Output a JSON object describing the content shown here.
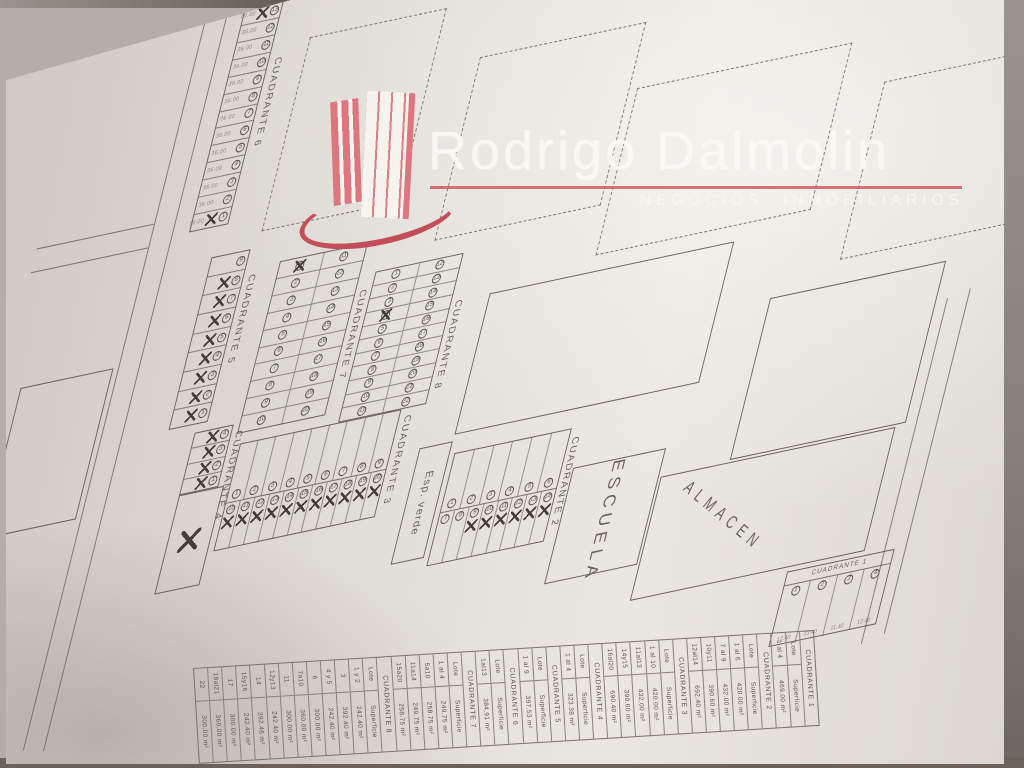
{
  "logo": {
    "brand": "Rodrigo Dalmolin",
    "tagline": "NEGOCIOS INMOBILIARIOS",
    "brand_color": "#f7f4ef",
    "accent_color": "#cf5a62",
    "icon": "building-icon"
  },
  "plan": {
    "areas": {
      "school": "ESCUELA",
      "warehouse": "ALMACEN",
      "green": "Esp. verde"
    },
    "c6": {
      "label": "CUADRANTE 6",
      "dim": "36.00",
      "lots": [
        {
          "n": "13",
          "x": true
        },
        {
          "n": "12"
        },
        {
          "n": "11"
        },
        {
          "n": "10"
        },
        {
          "n": "9"
        },
        {
          "n": "8"
        },
        {
          "n": "7"
        },
        {
          "n": "6"
        },
        {
          "n": "5"
        },
        {
          "n": "4"
        },
        {
          "n": "3"
        },
        {
          "n": "2"
        },
        {
          "n": "1",
          "x": true
        }
      ]
    },
    "c5": {
      "label": "CUADRANTE 5",
      "lots": [
        {
          "n": "9"
        },
        {
          "n": "8",
          "x": true
        },
        {
          "n": "7",
          "x": true
        },
        {
          "n": "6",
          "x": true
        },
        {
          "n": "5",
          "x": true
        },
        {
          "n": "4",
          "x": true
        },
        {
          "n": "3",
          "x": true
        },
        {
          "n": "2",
          "x": true
        },
        {
          "n": "1",
          "x": true
        }
      ]
    },
    "c4": {
      "label": "CUADRANTE 4",
      "lots": [
        {
          "n": "4",
          "x": true
        },
        {
          "n": "3",
          "x": true
        },
        {
          "n": "2",
          "x": true
        },
        {
          "n": "1",
          "x": true
        }
      ],
      "big_lot": {
        "x": true
      }
    },
    "c7": {
      "label": "CUADRANTE 7",
      "rows": [
        [
          {
            "n": "1",
            "x": true
          },
          {
            "n": "11"
          }
        ],
        [
          {
            "n": "2"
          },
          {
            "n": "12"
          }
        ],
        [
          {
            "n": "3"
          },
          {
            "n": "13"
          }
        ],
        [
          {
            "n": "4"
          },
          {
            "n": "14"
          }
        ],
        [
          {
            "n": "5"
          },
          {
            "n": "15"
          }
        ],
        [
          {
            "n": "6"
          },
          {
            "n": "16"
          }
        ],
        [
          {
            "n": "7"
          },
          {
            "n": "17"
          }
        ],
        [
          {
            "n": "8"
          },
          {
            "n": "18"
          }
        ],
        [
          {
            "n": "9"
          },
          {
            "n": "19"
          }
        ],
        [
          {
            "n": "10"
          },
          {
            "n": "20"
          }
        ]
      ]
    },
    "c8": {
      "label": "CUADRANTE 8",
      "rows": [
        [
          {
            "n": "1"
          },
          {
            "n": "12"
          }
        ],
        [
          {
            "n": "2"
          },
          {
            "n": "13"
          }
        ],
        [
          {
            "n": "3"
          },
          {
            "n": "14"
          }
        ],
        [
          {
            "n": "4",
            "x": true
          },
          {
            "n": "15"
          }
        ],
        [
          {
            "n": "5"
          },
          {
            "n": "16"
          }
        ],
        [
          {
            "n": "6"
          },
          {
            "n": "17"
          }
        ],
        [
          {
            "n": "7"
          },
          {
            "n": "18"
          }
        ],
        [
          {
            "n": "8"
          },
          {
            "n": "19"
          }
        ],
        [
          {
            "n": "9"
          },
          {
            "n": "20"
          }
        ],
        [
          {
            "n": "10"
          },
          {
            "n": "21"
          }
        ],
        [
          {
            "n": "11"
          },
          {
            "n": "22"
          }
        ]
      ]
    },
    "c3": {
      "label": "CUADRANTE 3",
      "top": [
        {
          "n": "1"
        },
        {
          "n": "2"
        },
        {
          "n": "3"
        },
        {
          "n": "4"
        },
        {
          "n": "5"
        },
        {
          "n": "6"
        },
        {
          "n": "7"
        },
        {
          "n": "8"
        },
        {
          "n": "9"
        }
      ],
      "bottom": [
        {
          "n": "10",
          "x": true
        },
        {
          "n": "11",
          "x": true
        },
        {
          "n": "12",
          "x": true
        },
        {
          "n": "13",
          "x": true
        },
        {
          "n": "14",
          "x": true
        },
        {
          "n": "15",
          "x": true
        },
        {
          "n": "16",
          "x": true
        },
        {
          "n": "17",
          "x": true
        },
        {
          "n": "18",
          "x": true
        },
        {
          "n": "19",
          "x": true
        },
        {
          "n": "20",
          "x": true
        }
      ]
    },
    "c2": {
      "label": "CUADRANTE 2",
      "top": [
        {
          "n": "1"
        },
        {
          "n": "2"
        },
        {
          "n": "3"
        },
        {
          "n": "4"
        },
        {
          "n": "5"
        },
        {
          "n": "6"
        }
      ],
      "bottom": [
        {
          "n": "7"
        },
        {
          "n": "8"
        },
        {
          "n": "9",
          "x": true
        },
        {
          "n": "10",
          "x": true
        },
        {
          "n": "11",
          "x": true
        },
        {
          "n": "12",
          "x": true
        },
        {
          "n": "13",
          "x": true
        },
        {
          "n": "14",
          "x": true
        }
      ]
    },
    "c1": {
      "label": "CUADRANTE 1",
      "lots": [
        {
          "n": "1",
          "dim": "12.40"
        },
        {
          "n": "2",
          "dim": "13.40"
        },
        {
          "n": "3",
          "dim": "11.40"
        },
        {
          "n": "4",
          "dim": "12.40"
        }
      ]
    }
  },
  "table": {
    "unit": "m²",
    "groups": [
      {
        "name": "CUADRANTE 1",
        "header": [
          "Lote",
          "Superficie"
        ],
        "rows": [
          [
            "1 al 4",
            "469.00 m²"
          ]
        ]
      },
      {
        "name": "CUADRANTE 2",
        "header": [
          "Lote",
          "Superficie"
        ],
        "rows": [
          [
            "1 al 6",
            "420.00 m²"
          ],
          [
            "7 al 9",
            "432.00 m²"
          ],
          [
            "10y11",
            "390.60 m²"
          ],
          [
            "12al14",
            "692.40 m²"
          ]
        ]
      },
      {
        "name": "CUADRANTE 3",
        "header": [
          "Lote",
          "Superficie"
        ],
        "rows": [
          [
            "1 al 10",
            "420.00 m²"
          ],
          [
            "11al13",
            "432.00 m²"
          ],
          [
            "14y15",
            "390.60 m²"
          ],
          [
            "16al20",
            "690.40 m²"
          ]
        ]
      },
      {
        "name": "CUADRANTE 4",
        "header": [
          "Lote",
          "Superficie"
        ],
        "rows": [
          [
            "1 al 4",
            "323.38 m²"
          ]
        ]
      },
      {
        "name": "CUADRANTE 5",
        "header": [
          "Lote",
          "Superficie"
        ],
        "rows": [
          [
            "1 al 9",
            "397.53 m²"
          ]
        ]
      },
      {
        "name": "CUADRANTE 6",
        "header": [
          "Lote",
          "Superficie"
        ],
        "rows": [
          [
            "1al13",
            "384.91 m²"
          ]
        ]
      },
      {
        "name": "CUADRANTE 7",
        "header": [
          "Lote",
          "Superficie"
        ],
        "rows": [
          [
            "1 al 4",
            "249.75 m²"
          ],
          [
            "5a10",
            "258.75 m²"
          ],
          [
            "11a14",
            "249.75 m²"
          ],
          [
            "15a20",
            "258.75 m²"
          ]
        ]
      },
      {
        "name": "CUADRANTE 8",
        "header": [
          "Lote",
          "Superficie"
        ],
        "rows": [
          [
            "1 y 2",
            "242.40 m²"
          ],
          [
            "3",
            "392.40 m²"
          ],
          [
            "4 y 5",
            "242.40 m²"
          ],
          [
            "6",
            "300.00 m²"
          ],
          [
            "7a10",
            "360.00 m²"
          ],
          [
            "11",
            "300.00 m²"
          ],
          [
            "12y13",
            "242.40 m²"
          ],
          [
            "14",
            "392.46 m²"
          ],
          [
            "15y16",
            "242.40 m²"
          ],
          [
            "17",
            "300.00 m²"
          ],
          [
            "18al21",
            "360.00 m²"
          ],
          [
            "22",
            "300.00 m²"
          ]
        ]
      }
    ]
  }
}
